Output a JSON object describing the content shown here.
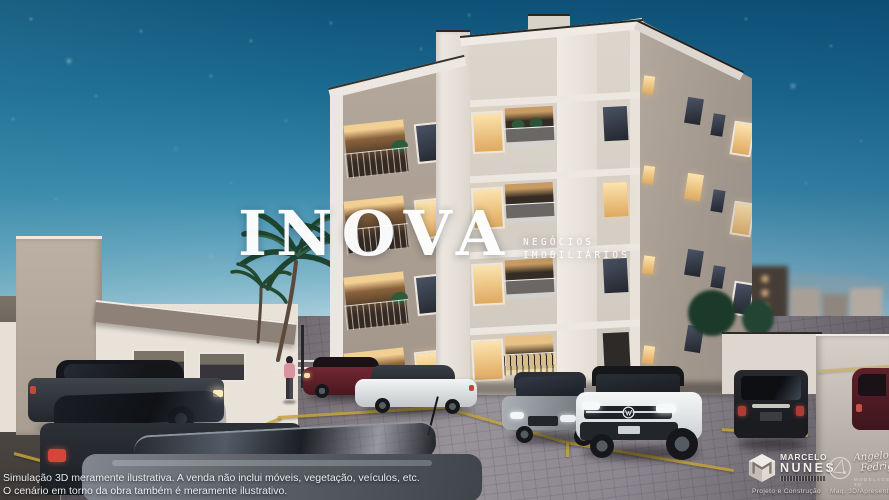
{
  "watermark": {
    "brand": "INOVA",
    "tagline_line1": "NEGÓCIOS",
    "tagline_line2": "IMOBILIÁRIOS"
  },
  "disclaimer": {
    "line1": "Simulação 3D meramente ilustrativa. A venda não inclui móveis, vegetação, veículos, etc.",
    "line2": "O cenário em torno da obra também é meramente ilustrativo."
  },
  "credits": {
    "architect": {
      "name_line1": "MARCELO",
      "name_line2": "NUNES",
      "role_caption": "Projeto e Construção"
    },
    "visualization": {
      "name_line1": "Angelo",
      "name_line2": "Fedrigo",
      "subtitle": "MODELAGEM 3D",
      "role_caption": "Maq. 3D/Apresentação"
    }
  },
  "scene": {
    "icons": {
      "architect_mark": "mn-monogram-cube-icon",
      "visualization_mark": "af-lens-circle-icon",
      "car_badge": "vw-logo-icon"
    },
    "colors": {
      "sky_top": "#0f5278",
      "sky_horizon": "#c6dee8",
      "window_light": "#f6d79b",
      "parking_line": "#c4a338",
      "watermark_text": "#ffffff"
    }
  }
}
